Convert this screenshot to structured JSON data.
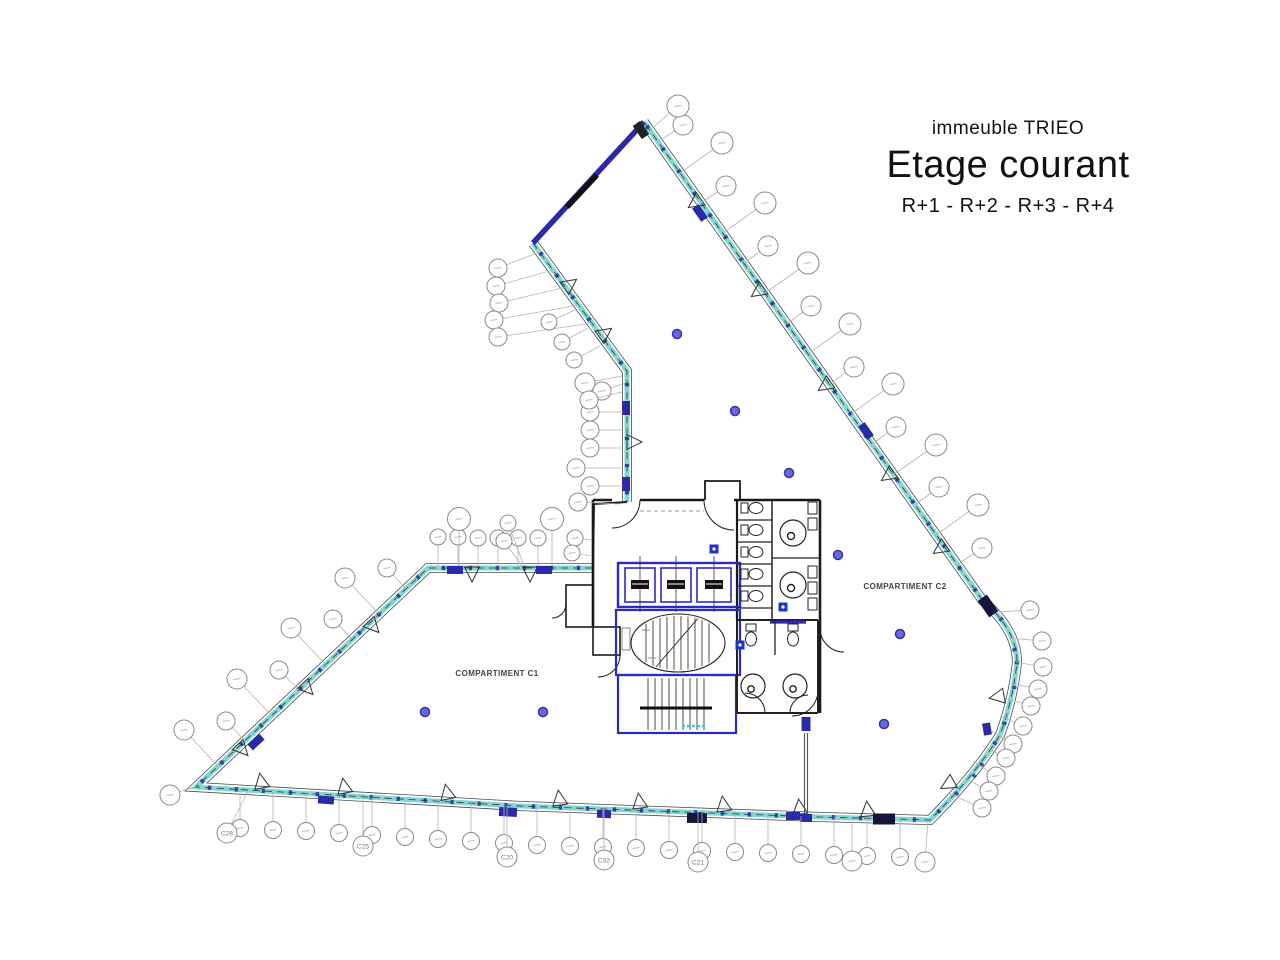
{
  "title": {
    "building": "immeuble TRIEO",
    "main": "Etage courant",
    "floors": "R+1 - R+2 - R+3 - R+4"
  },
  "compartments": {
    "c1": "COMPARTIMENT C1",
    "c2": "COMPARTIMENT C2"
  },
  "colors": {
    "facade_edge": "#4a4a4a",
    "facade_light": "#eef9f8",
    "facade_teal": "#7fd6d2",
    "navy": "#2a2aa8",
    "core_blue": "#2b2bc0",
    "wall": "#1a1a1a",
    "bubble_stroke": "#8a8a8a",
    "leader": "#b3b3b3",
    "dot_fill": "#6a6ad4",
    "dot_ring": "#3434a8",
    "tick": "#223399",
    "label_text": "#444444"
  },
  "plan": {
    "tick_lines": [
      {
        "pts": [
          [
            533,
            243
          ],
          [
            627,
            371
          ],
          [
            627,
            502
          ]
        ],
        "spacing": 27
      },
      {
        "pts": [
          [
            592,
            568
          ],
          [
            428,
            568
          ],
          [
            196,
            787
          ]
        ],
        "spacing": 27
      },
      {
        "pts": [
          [
            196,
            787
          ],
          [
            520,
            806
          ],
          [
            820,
            817
          ],
          [
            930,
            820
          ]
        ],
        "spacing": 27
      },
      {
        "pts": [
          [
            930,
            820
          ],
          [
            975,
            775
          ],
          [
            1000,
            735
          ],
          [
            1013,
            700
          ],
          [
            1017,
            662
          ],
          [
            1010,
            628
          ],
          [
            983,
            601
          ]
        ],
        "spacing": 25
      },
      {
        "pts": [
          [
            983,
            601
          ],
          [
            644,
            122
          ]
        ],
        "spacing": 27
      }
    ],
    "navy_blocks": [
      [
        700,
        213,
        55,
        16,
        8,
        ""
      ],
      [
        866,
        431,
        55,
        16,
        8,
        ""
      ],
      [
        988,
        606,
        55,
        20,
        11,
        "#14143c"
      ],
      [
        626,
        408,
        90,
        14,
        8,
        ""
      ],
      [
        626,
        484,
        90,
        14,
        8,
        ""
      ],
      [
        455,
        570,
        0,
        16,
        8,
        ""
      ],
      [
        544,
        570,
        0,
        16,
        8,
        ""
      ],
      [
        256,
        742,
        137,
        16,
        8,
        ""
      ],
      [
        326,
        800,
        4,
        16,
        8,
        ""
      ],
      [
        508,
        812,
        3,
        18,
        9,
        ""
      ],
      [
        604,
        814,
        2,
        14,
        8,
        ""
      ],
      [
        697,
        818,
        1,
        20,
        10,
        "#14143c"
      ],
      [
        793,
        816,
        0,
        14,
        8,
        ""
      ],
      [
        884,
        819,
        0,
        22,
        11,
        "#14143c"
      ],
      [
        987,
        729,
        80,
        12,
        8,
        ""
      ],
      [
        641,
        130,
        55,
        16,
        9,
        "#222222"
      ],
      [
        806,
        724,
        90,
        14,
        9,
        ""
      ],
      [
        806,
        818,
        0,
        12,
        8,
        ""
      ]
    ],
    "triangles": [
      [
        262,
        786,
        -10
      ],
      [
        345,
        791,
        -10
      ],
      [
        448,
        797,
        -12
      ],
      [
        560,
        803,
        -8
      ],
      [
        640,
        806,
        -8
      ],
      [
        724,
        809,
        -8
      ],
      [
        800,
        812,
        -6
      ],
      [
        868,
        814,
        -6
      ],
      [
        699,
        200,
        235
      ],
      [
        762,
        289,
        235
      ],
      [
        829,
        383,
        235
      ],
      [
        892,
        473,
        235
      ],
      [
        944,
        546,
        235
      ],
      [
        370,
        623,
        137
      ],
      [
        304,
        685,
        137
      ],
      [
        239,
        746,
        137
      ],
      [
        566,
        287,
        54
      ],
      [
        601,
        336,
        54
      ],
      [
        472,
        569,
        180
      ],
      [
        530,
        569,
        180
      ],
      [
        629,
        442,
        90
      ],
      [
        1002,
        696,
        260
      ],
      [
        952,
        782,
        240
      ]
    ],
    "callouts": [
      [
        683,
        125,
        658,
        142,
        10,
        ""
      ],
      [
        722,
        143,
        680,
        173,
        11,
        ""
      ],
      [
        726,
        186,
        701,
        203,
        10,
        ""
      ],
      [
        765,
        203,
        723,
        233,
        11,
        ""
      ],
      [
        768,
        246,
        744,
        263,
        10,
        ""
      ],
      [
        808,
        263,
        765,
        293,
        11,
        ""
      ],
      [
        811,
        306,
        787,
        324,
        10,
        ""
      ],
      [
        850,
        324,
        808,
        354,
        11,
        ""
      ],
      [
        854,
        367,
        829,
        384,
        10,
        ""
      ],
      [
        893,
        384,
        851,
        414,
        11,
        ""
      ],
      [
        896,
        427,
        872,
        444,
        10,
        ""
      ],
      [
        936,
        445,
        893,
        475,
        11,
        ""
      ],
      [
        939,
        487,
        915,
        505,
        10,
        ""
      ],
      [
        978,
        505,
        936,
        535,
        11,
        ""
      ],
      [
        982,
        548,
        957,
        565,
        10,
        ""
      ],
      [
        678,
        106,
        650,
        130,
        11,
        ""
      ],
      [
        1030,
        610,
        998,
        612,
        9,
        ""
      ],
      [
        1042,
        641,
        1010,
        638,
        9,
        ""
      ],
      [
        1043,
        667,
        1016,
        662,
        9,
        ""
      ],
      [
        1038,
        689,
        1014,
        684,
        9,
        ""
      ],
      [
        1031,
        706,
        1008,
        699,
        9,
        ""
      ],
      [
        1023,
        726,
        1000,
        716,
        9,
        ""
      ],
      [
        1013,
        744,
        991,
        731,
        9,
        ""
      ],
      [
        1006,
        758,
        983,
        746,
        9,
        ""
      ],
      [
        996,
        776,
        973,
        761,
        9,
        ""
      ],
      [
        989,
        791,
        963,
        777,
        9,
        ""
      ],
      [
        982,
        808,
        950,
        794,
        9,
        ""
      ],
      [
        240,
        828,
        240,
        790,
        8.5,
        ""
      ],
      [
        273,
        830,
        273,
        792,
        8.5,
        ""
      ],
      [
        306,
        831,
        306,
        793,
        8.5,
        ""
      ],
      [
        339,
        833,
        339,
        795,
        8.5,
        ""
      ],
      [
        372,
        835,
        372,
        797,
        8.5,
        ""
      ],
      [
        405,
        837,
        405,
        799,
        8.5,
        ""
      ],
      [
        438,
        839,
        438,
        801,
        8.5,
        ""
      ],
      [
        471,
        841,
        471,
        803,
        8.5,
        ""
      ],
      [
        504,
        843,
        504,
        805,
        8.5,
        ""
      ],
      [
        537,
        845,
        537,
        807,
        8.5,
        ""
      ],
      [
        570,
        846,
        570,
        808,
        8.5,
        ""
      ],
      [
        603,
        847,
        603,
        809,
        8.5,
        ""
      ],
      [
        636,
        848,
        636,
        810,
        8.5,
        ""
      ],
      [
        669,
        850,
        669,
        812,
        8.5,
        ""
      ],
      [
        702,
        851,
        702,
        813,
        8.5,
        ""
      ],
      [
        735,
        852,
        735,
        814,
        8.5,
        ""
      ],
      [
        768,
        853,
        768,
        815,
        8.5,
        ""
      ],
      [
        801,
        854,
        801,
        816,
        8.5,
        ""
      ],
      [
        834,
        855,
        834,
        817,
        8.5,
        ""
      ],
      [
        867,
        856,
        867,
        818,
        8.5,
        ""
      ],
      [
        900,
        857,
        900,
        819,
        8.5,
        ""
      ],
      [
        227,
        833,
        248,
        791,
        10,
        "C28"
      ],
      [
        363,
        846,
        363,
        797,
        10,
        "C25"
      ],
      [
        507,
        857,
        507,
        805,
        10,
        "C20"
      ],
      [
        604,
        860,
        604,
        809,
        10,
        "C32"
      ],
      [
        698,
        862,
        698,
        813,
        10,
        "C21"
      ],
      [
        852,
        861,
        852,
        818,
        10,
        ""
      ],
      [
        925,
        862,
        928,
        821,
        10,
        ""
      ],
      [
        387,
        568,
        406,
        589,
        9,
        ""
      ],
      [
        345,
        578,
        379,
        614,
        10,
        ""
      ],
      [
        333,
        619,
        352,
        639,
        9,
        ""
      ],
      [
        291,
        628,
        326,
        665,
        10,
        ""
      ],
      [
        279,
        670,
        299,
        690,
        9,
        ""
      ],
      [
        237,
        679,
        272,
        716,
        10,
        ""
      ],
      [
        226,
        721,
        245,
        741,
        9,
        ""
      ],
      [
        184,
        730,
        218,
        766,
        10,
        ""
      ],
      [
        170,
        795,
        194,
        787,
        10,
        ""
      ],
      [
        438,
        537,
        438,
        566,
        8,
        ""
      ],
      [
        458,
        537,
        458,
        566,
        8,
        ""
      ],
      [
        478,
        538,
        478,
        566,
        8,
        ""
      ],
      [
        498,
        538,
        498,
        566,
        8,
        ""
      ],
      [
        518,
        538,
        518,
        566,
        8,
        ""
      ],
      [
        538,
        538,
        538,
        566,
        8,
        ""
      ],
      [
        459,
        519,
        459,
        566,
        11.5,
        ""
      ],
      [
        552,
        519,
        552,
        566,
        11.5,
        ""
      ],
      [
        508,
        523,
        524,
        566,
        8,
        ""
      ],
      [
        504,
        541,
        522,
        566,
        8,
        ""
      ],
      [
        575,
        538,
        592,
        540,
        8,
        ""
      ],
      [
        572,
        553,
        592,
        556,
        8,
        ""
      ],
      [
        590,
        412,
        623,
        412,
        9,
        ""
      ],
      [
        590,
        430,
        623,
        430,
        9,
        ""
      ],
      [
        590,
        448,
        623,
        448,
        9,
        ""
      ],
      [
        576,
        468,
        623,
        468,
        9,
        ""
      ],
      [
        590,
        486,
        623,
        486,
        9,
        ""
      ],
      [
        578,
        502,
        620,
        504,
        9,
        ""
      ],
      [
        585,
        383,
        622,
        376,
        10,
        ""
      ],
      [
        602,
        391,
        625,
        383,
        9,
        ""
      ],
      [
        589,
        400,
        622,
        392,
        9,
        ""
      ],
      [
        498,
        268,
        540,
        252,
        9,
        ""
      ],
      [
        496,
        286,
        553,
        270,
        9,
        ""
      ],
      [
        499,
        303,
        566,
        287,
        9,
        ""
      ],
      [
        494,
        320,
        579,
        305,
        9,
        ""
      ],
      [
        498,
        337,
        592,
        323,
        9,
        ""
      ],
      [
        549,
        322,
        575,
        310,
        8,
        ""
      ],
      [
        562,
        342,
        588,
        328,
        8,
        ""
      ],
      [
        574,
        360,
        600,
        346,
        8,
        ""
      ]
    ],
    "dots": [
      [
        677,
        334
      ],
      [
        735,
        411
      ],
      [
        789,
        473
      ],
      [
        838,
        555
      ],
      [
        900,
        634
      ],
      [
        884,
        724
      ],
      [
        425,
        712
      ],
      [
        543,
        712
      ]
    ],
    "blue_squares": [
      [
        714,
        549
      ],
      [
        783,
        607
      ],
      [
        740,
        645
      ]
    ]
  }
}
